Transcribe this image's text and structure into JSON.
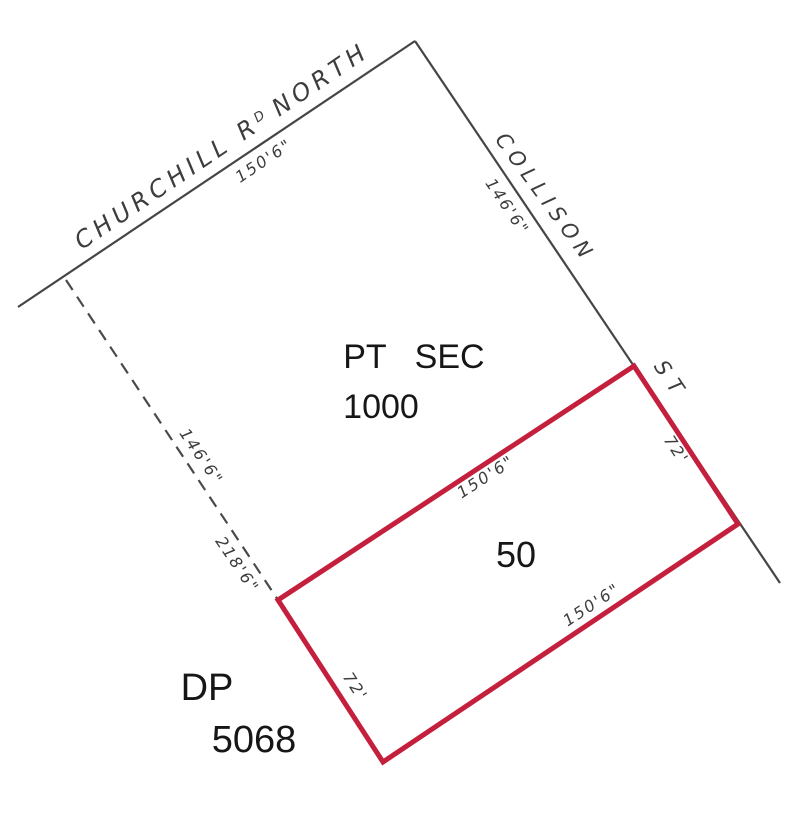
{
  "accent_color": "#c41f3c",
  "plan": {
    "churchill_road": {
      "name_prefix": "CHURCHILL R",
      "name_superscript": "D",
      "name_suffix": "NORTH",
      "frontage_dimension": "150'6\""
    },
    "collison_street": {
      "name": "COLLISON",
      "name_abbrev": "ST",
      "frontage_dimension": "146'6\""
    },
    "west_boundary": {
      "upper_dimension": "146'6\"",
      "lower_dimension": "218'6\""
    },
    "parent_parcel": {
      "type_word1": "PT",
      "type_word2": "SEC",
      "number": "1000"
    },
    "lot": {
      "number": "50",
      "street_side_dimension": "72'",
      "rear_side_dimension": "72'",
      "north_side_dimension": "150'6\"",
      "south_side_dimension": "150'6\""
    },
    "deposited_plan": {
      "label": "DP",
      "number": "5068"
    }
  }
}
